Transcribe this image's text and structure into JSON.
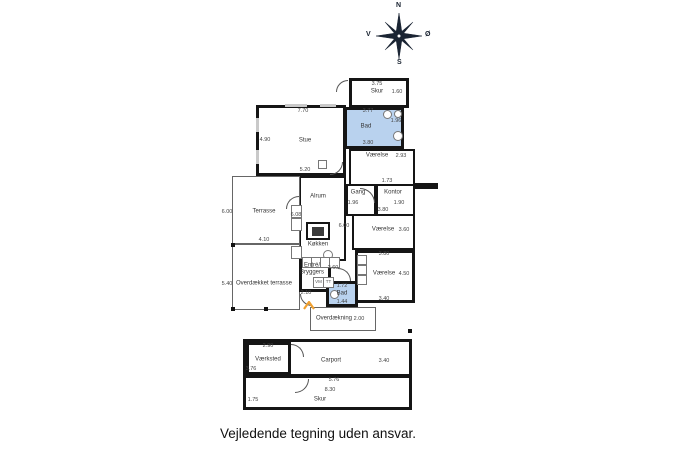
{
  "disclaimer": "Vejledende tegning uden ansvar.",
  "compass": {
    "north": "N",
    "south": "S",
    "west": "V",
    "east": "Ø"
  },
  "colors": {
    "wall": "#151515",
    "bath_fill": "#b9d2ee",
    "entrance_arrow": "#f0a030"
  },
  "appliances": {
    "washer": "VM",
    "dryer": "TT"
  },
  "rooms": {
    "skur_top": {
      "label": "Skur",
      "dim_top": "3.75",
      "dim_right": "1.60"
    },
    "bad_top": {
      "label": "Bad",
      "dim_top": "3.77",
      "dim_right": "1.96",
      "dim_bottom": "3.80"
    },
    "stue": {
      "label": "Stue",
      "dim_top": "7.70",
      "dim_left": "4.90",
      "dim_bottom": "5.20"
    },
    "vaerelse_ne": {
      "label": "Værelse",
      "dim_right": "2.93"
    },
    "gang": {
      "label": "Gang",
      "dim_top": "1.73",
      "dim_left": "1.96"
    },
    "kontor": {
      "label": "Kontor",
      "dim_right": "1.90"
    },
    "vaerelse_e": {
      "label": "Værelse",
      "dim_top": "3.80",
      "dim_right": "3.60"
    },
    "vaerelse_se": {
      "label": "Værelse",
      "dim_top": "3.80",
      "dim_right": "4.50",
      "dim_bottom": "3.40"
    },
    "alrum": {
      "label": "Alrum",
      "dim_right": "6.00"
    },
    "koekken": {
      "label": "Køkken",
      "dim_left": "6.08"
    },
    "terrasse": {
      "label": "Terrasse",
      "dim_left": "6.00",
      "dim_bottom": "4.10"
    },
    "overdaekket_terrasse": {
      "label": "Overdækket terrasse",
      "dim_left": "5.40"
    },
    "entre_bryggers": {
      "label_line1": "Entré/",
      "label_line2": "Bryggers",
      "dim_right": "2.60",
      "dim_left": "2.10"
    },
    "bad_small": {
      "label": "Bad",
      "dim_top": "1.72",
      "dim_bottom": "1.44"
    },
    "overdaekning": {
      "label": "Overdækning",
      "dim_right": "2.00"
    },
    "vaerksted": {
      "label": "Værksted",
      "dim_top": "2.90",
      "dim_left": "3.76"
    },
    "carport": {
      "label": "Carport",
      "dim_right": "3.40",
      "dim_bottom": "5.76"
    },
    "skur_bottom": {
      "label": "Skur",
      "dim_top": "8.30",
      "dim_left": "1.75"
    }
  }
}
